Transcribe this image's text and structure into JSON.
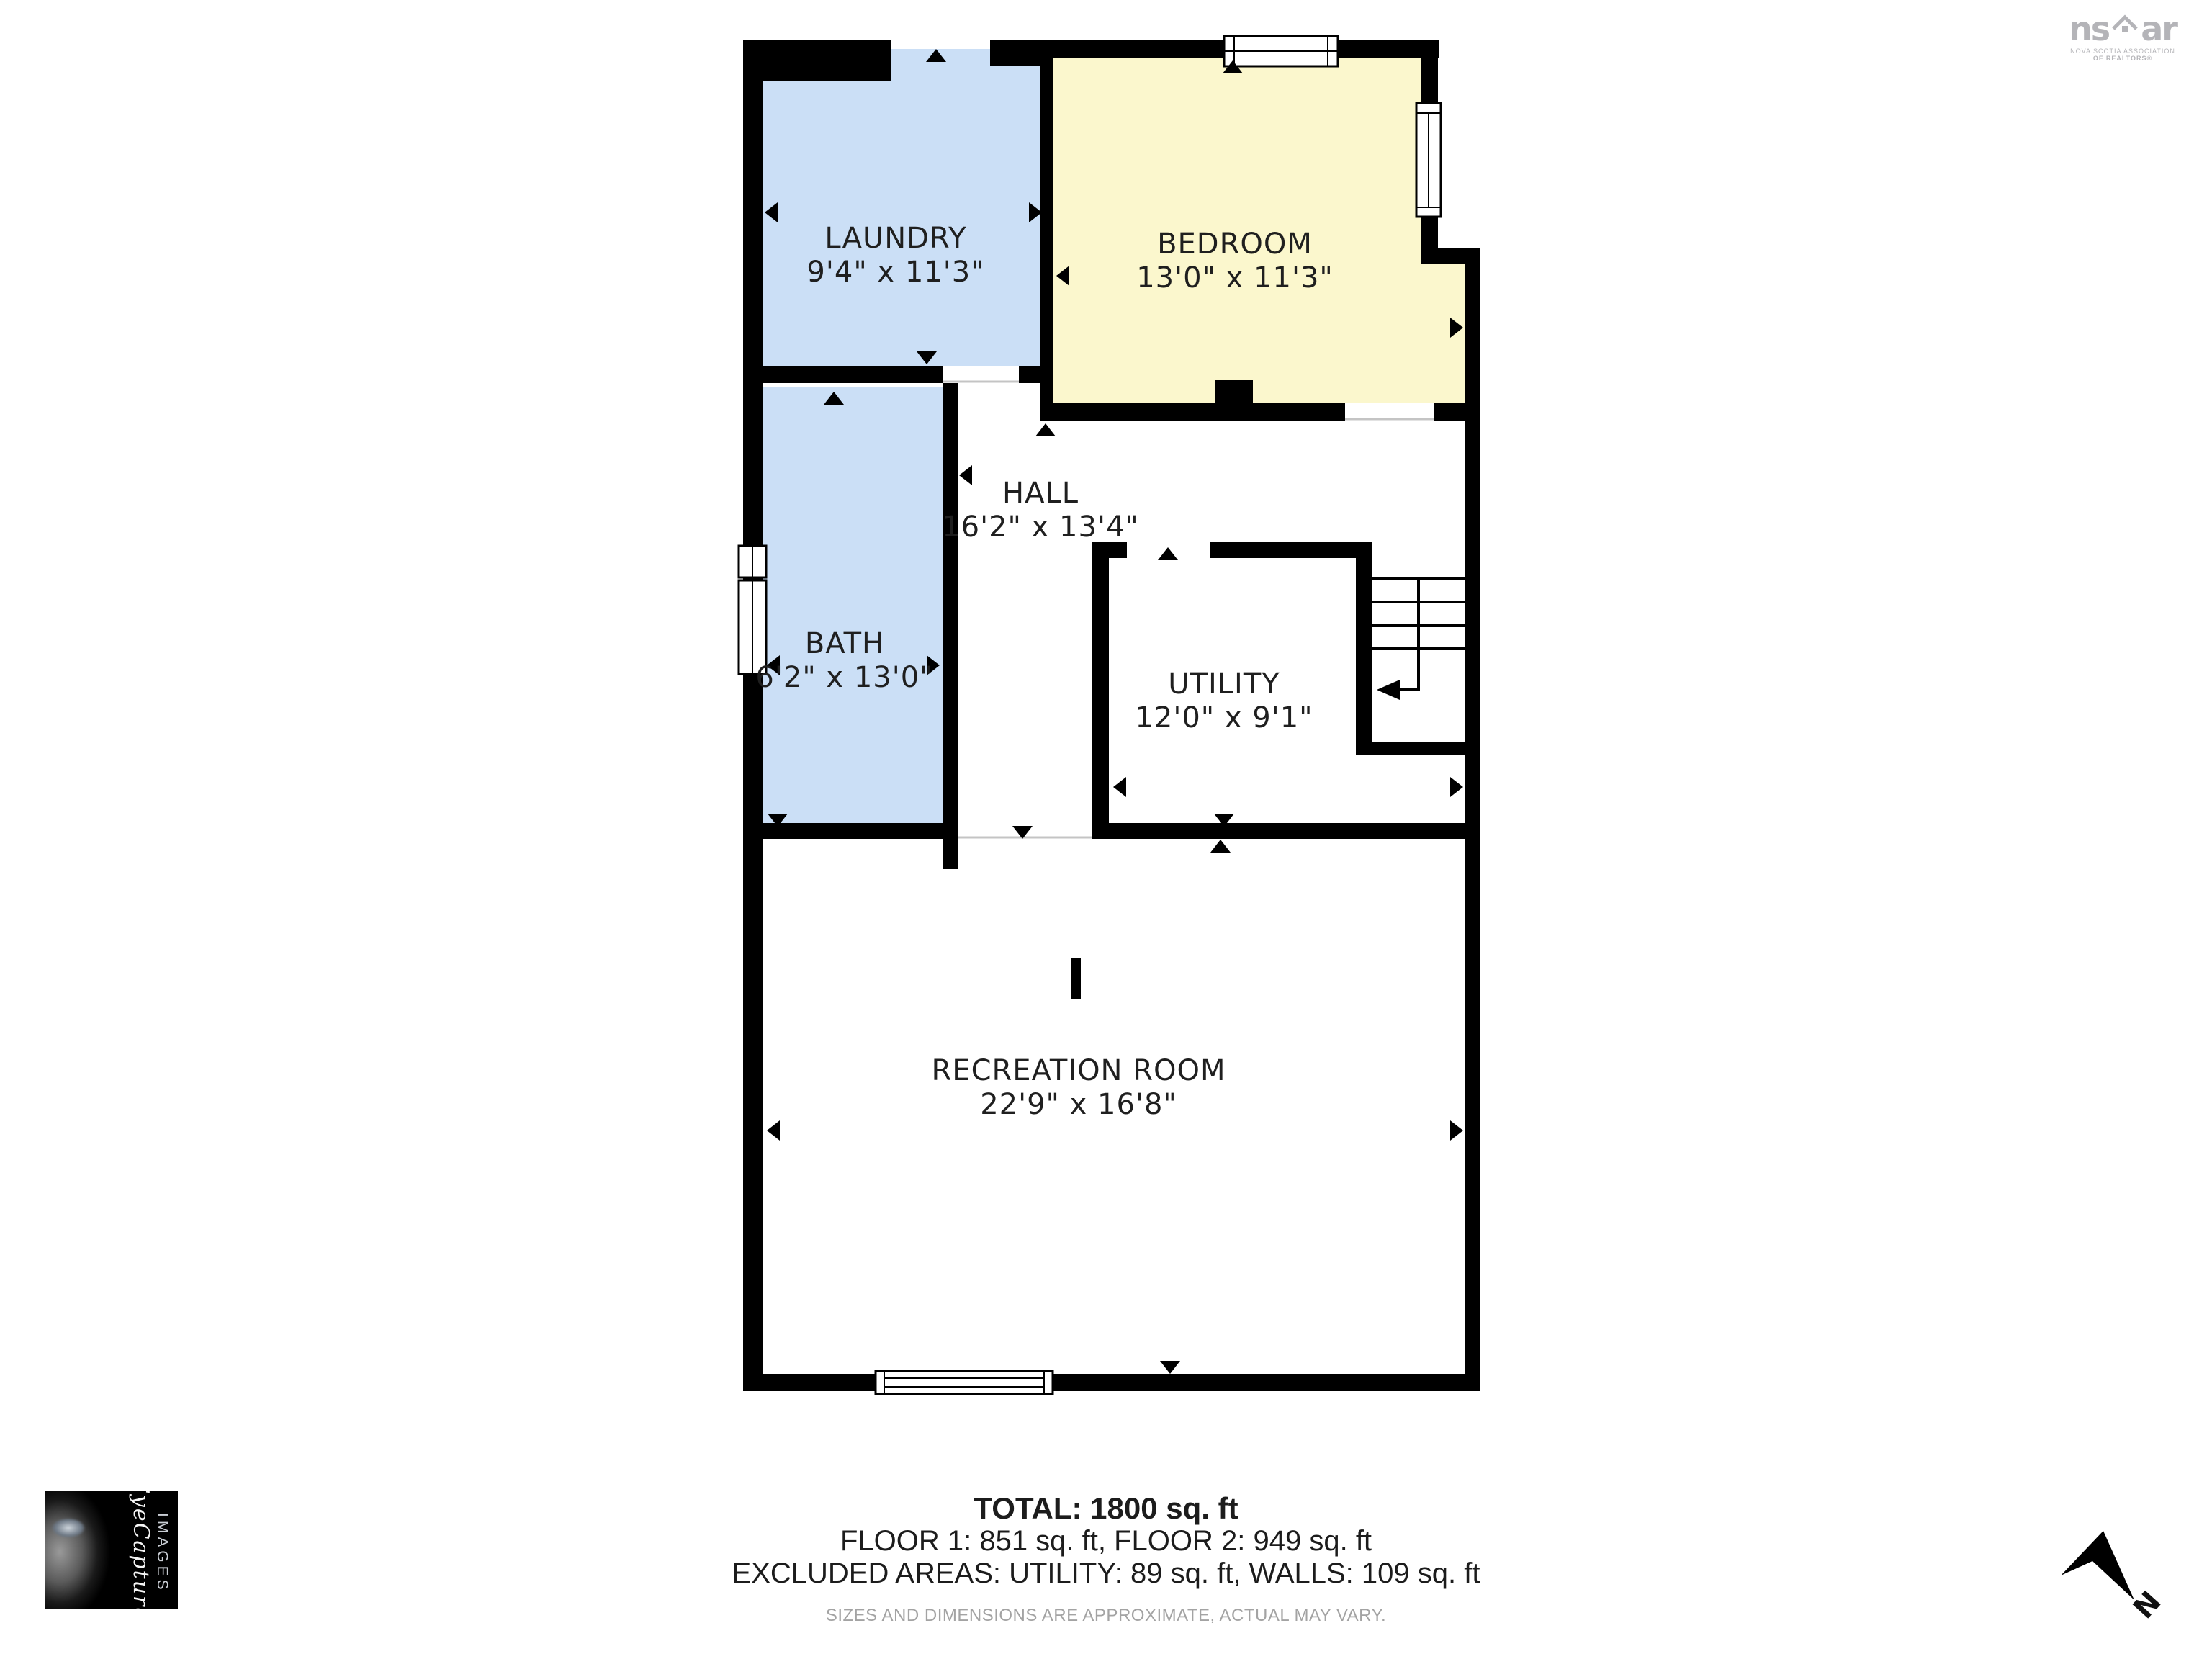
{
  "colors": {
    "wall": "#000000",
    "room_blue": "#cbdff6",
    "room_yellow": "#fbf7cd",
    "label": "#1f1f1f",
    "threshold": "#c4c4c4",
    "brand_gray": "#b4b4b8"
  },
  "rooms": {
    "laundry": {
      "name": "LAUNDRY",
      "dims": "9'4\" x 11'3\""
    },
    "bedroom": {
      "name": "BEDROOM",
      "dims": "13'0\" x 11'3\""
    },
    "hall": {
      "name": "HALL",
      "dims": "16'2\" x 13'4\""
    },
    "bath": {
      "name": "BATH",
      "dims": "6'2\" x 13'0\""
    },
    "utility": {
      "name": "UTILITY",
      "dims": "12'0\" x 9'1\""
    },
    "recreation": {
      "name": "RECREATION ROOM",
      "dims": "22'9\" x 16'8\""
    }
  },
  "summary": {
    "total": "TOTAL: 1800 sq. ft",
    "floors": "FLOOR 1: 851 sq. ft, FLOOR 2: 949 sq. ft",
    "excluded": "EXCLUDED AREAS: UTILITY: 89 sq. ft, WALLS: 109 sq. ft",
    "disclaimer": "SIZES AND DIMENSIONS ARE APPROXIMATE, ACTUAL MAY VARY."
  },
  "branding": {
    "nsar": {
      "ns": "ns",
      "ar": "ar",
      "line1": "NOVA SCOTIA ASSOCIATION",
      "line2": "OF REALTORS®"
    },
    "eyecapture": {
      "script": "EyeCapture",
      "sub": "IMAGES"
    }
  },
  "compass": {
    "label": "N"
  }
}
